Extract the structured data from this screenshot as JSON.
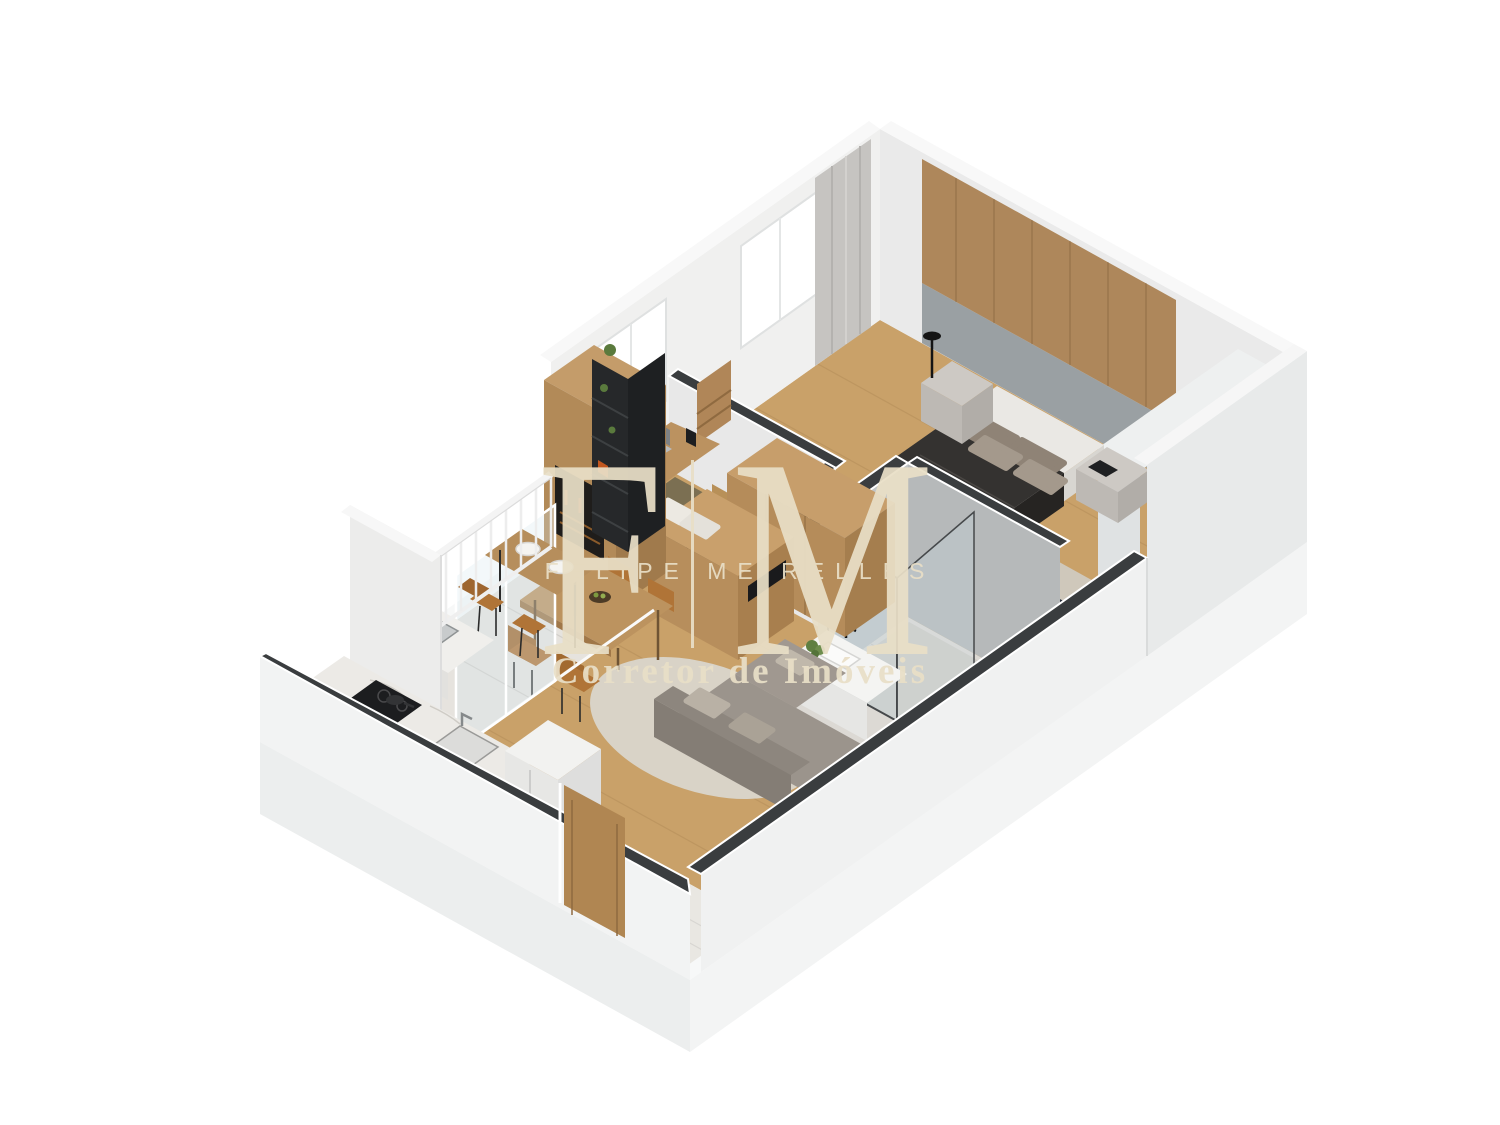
{
  "watermark": {
    "monogram_left": "F",
    "monogram_right": "M",
    "name": "FELIPE MEIRELLES",
    "tagline": "Corretor de Imóveis"
  },
  "colors": {
    "background": "#ffffff",
    "watermark_cream": "#e9dfc7",
    "wall_white": "#f0f1f1",
    "wall_cap_dark": "#3a3d3f",
    "wood_floor": "#c9a169",
    "wood_furniture": "#b58c5a",
    "headboard_wood": "#ae875b",
    "bed_duvet_dark": "#343230",
    "pillow_gray": "#8f8376",
    "sofa_gray": "#9b948c",
    "rug_cream": "#d9d3c7",
    "chair_caramel": "#b07437",
    "bathroom_concrete": "#b6b9ba",
    "shelf_black": "#26282a",
    "kitchen_marble": "#eceae6"
  }
}
